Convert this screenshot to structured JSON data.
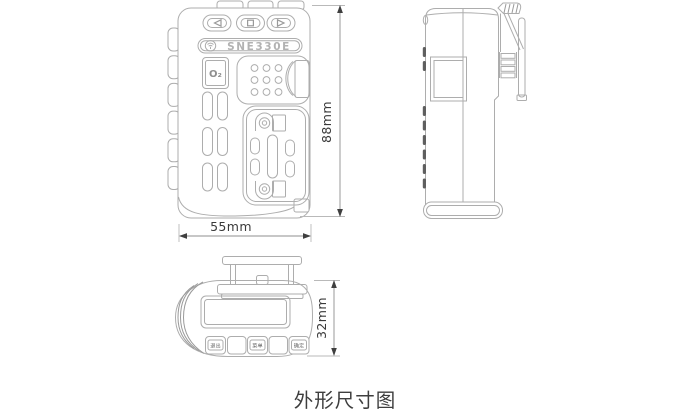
{
  "caption": "外形尺寸图",
  "front_view": {
    "model_label": "SNE330E",
    "o2_label": "O₂",
    "button_icons": [
      "left-triangle",
      "square",
      "right-triangle"
    ],
    "logo_icon": "antenna-logo"
  },
  "top_view": {
    "key_labels": [
      "退出",
      "菜单",
      "确定"
    ]
  },
  "dimensions": {
    "height": "88mm",
    "width": "55mm",
    "thickness": "32mm"
  }
}
